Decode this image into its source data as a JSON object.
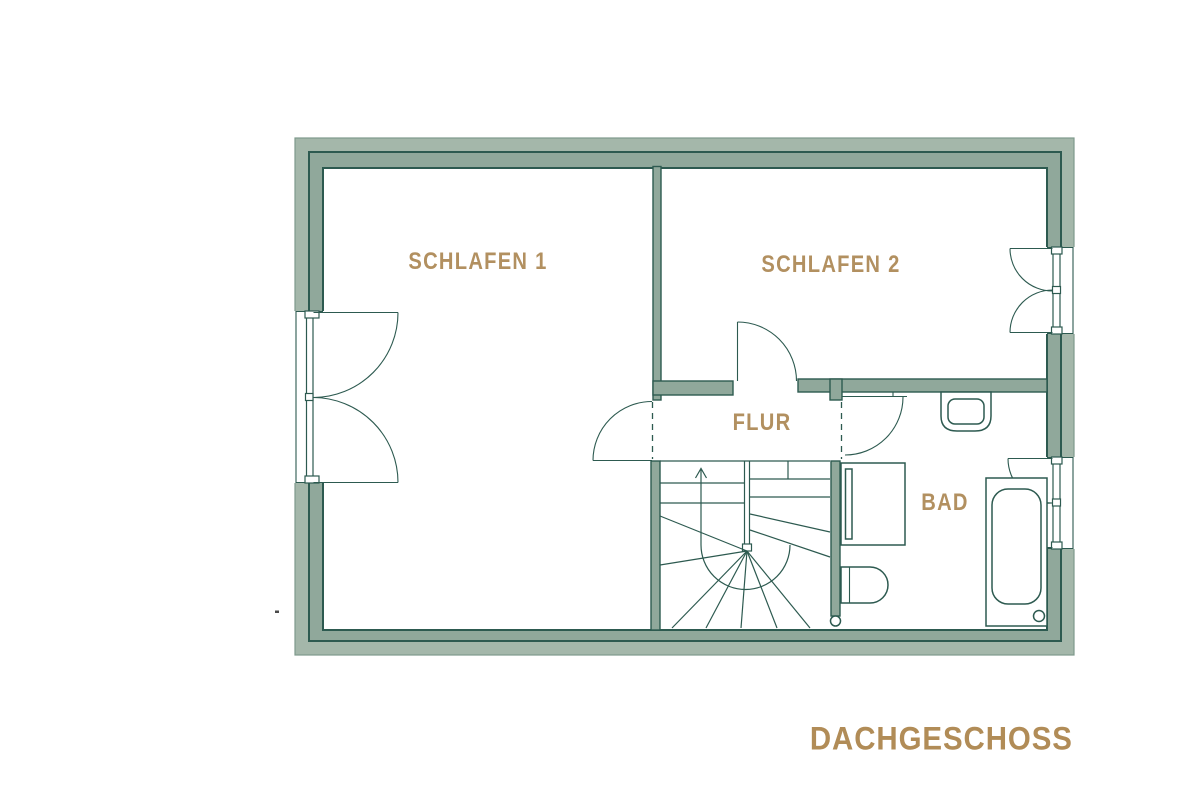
{
  "plan": {
    "floor_title": "DACHGESCHOSS",
    "stairs_direction": "up"
  },
  "rooms": {
    "schlafen1": {
      "label": "SCHLAFEN 1"
    },
    "schlafen2": {
      "label": "SCHLAFEN 2"
    },
    "flur": {
      "label": "FLUR"
    },
    "bad": {
      "label": "BAD"
    }
  },
  "colors": {
    "wall_fill_outer": "#A4B7AA",
    "wall_fill_inner": "#90A89B",
    "wall_line": "#2D5A50",
    "wall_edge_soft": "#7E998C",
    "line": "#2D5A50",
    "label": "#B29060",
    "title": "#B18C57"
  }
}
